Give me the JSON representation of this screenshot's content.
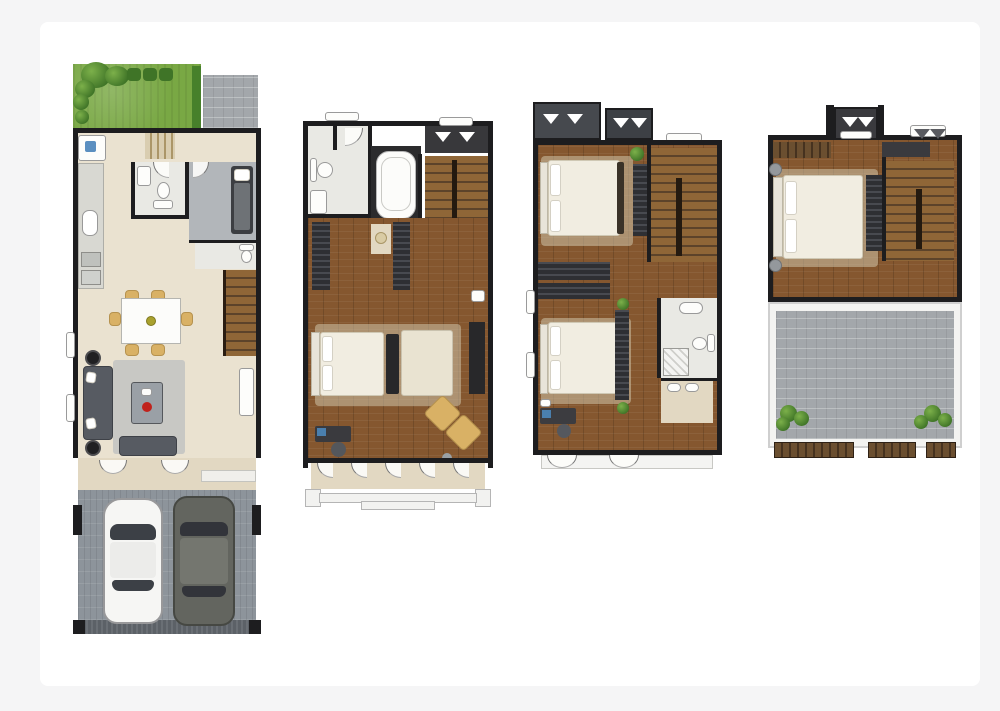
{
  "canvas": {
    "outer_background": "#f5f5f6",
    "sheet_background": "#ffffff",
    "description": "Four townhouse floor plans side by side, no text labels"
  },
  "palette": {
    "wall": "#1d1d1f",
    "wood_floor": "#85572f",
    "stair_wood": "#8f6637",
    "grass_green": "#79a844",
    "plant_green": "#3f7427",
    "paver_gray": "#a3a7ab",
    "garage_gray": "#8d949b",
    "tile": "#e9e9e4",
    "cream_floor": "#eae2d0",
    "dark_furniture": "#2c2c2e",
    "tan_chair": "#d9b165",
    "bed_linen": "#f1ede1",
    "sofa_gray": "#575b62",
    "red_accent": "#c0221c",
    "blue_accent": "#4a7fae"
  },
  "plans": [
    {
      "id": "plan-ground-floor",
      "features": [
        "garden",
        "trees",
        "patio",
        "kitchen-counter",
        "appliances",
        "bathroom",
        "maid-room",
        "wc",
        "staircase",
        "dining-table",
        "six-chairs",
        "sofa",
        "coffee-table",
        "rug",
        "bay-windows",
        "entry-porch",
        "garage",
        "white-car",
        "gray-suv"
      ]
    },
    {
      "id": "plan-second-floor",
      "features": [
        "bathroom",
        "toilet",
        "basin",
        "bathtub",
        "wardrobes",
        "staircase",
        "master-bedroom",
        "double-bed",
        "foot-bench",
        "chaise",
        "tv-console",
        "armchairs",
        "desk",
        "balcony",
        "parapet"
      ]
    },
    {
      "id": "plan-third-floor",
      "features": [
        "wardrobes",
        "staircase",
        "bedroom",
        "double-bed",
        "corridor-wardrobes",
        "second-bedroom",
        "double-bed",
        "bathroom",
        "shower",
        "vanity-basins",
        "desk",
        "plants",
        "french-doors"
      ]
    },
    {
      "id": "plan-roof-floor",
      "features": [
        "closet",
        "staircase",
        "bedroom",
        "double-bed",
        "wardrobe",
        "roof-terrace",
        "shrubs",
        "planter-boxes"
      ]
    }
  ]
}
